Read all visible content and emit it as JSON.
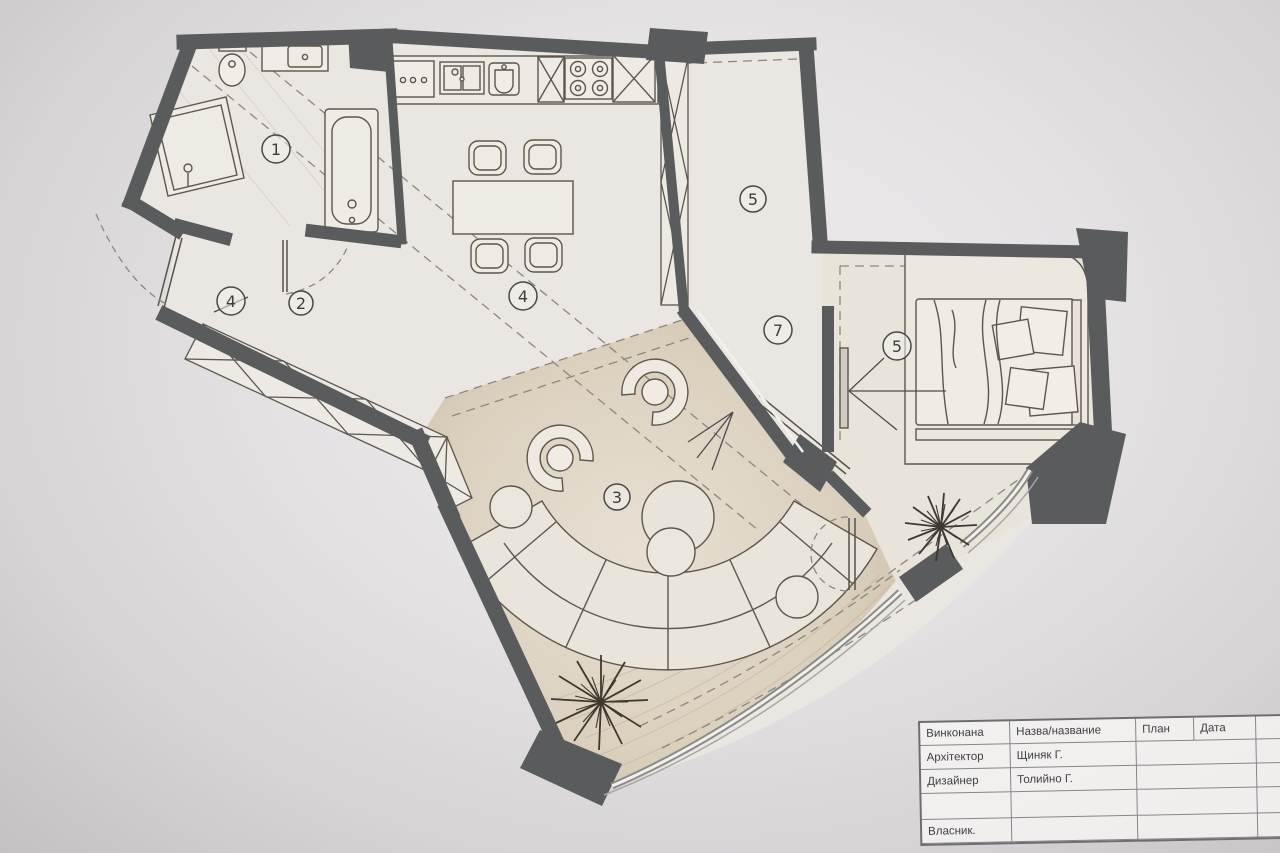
{
  "room_labels": {
    "bathroom": "1",
    "hallway": "2",
    "entry_marker": "4",
    "living": "3",
    "dining": "4",
    "corridor_wardrobe": "5",
    "bedroom_marker": "5",
    "door_marker": "7"
  },
  "title_block": {
    "header": {
      "c1": "Винконана",
      "c2": "Назва/название",
      "c3": "План",
      "c4": "Дата"
    },
    "rows": [
      [
        "Архітектор",
        "Щиняк Г."
      ],
      [
        "Дизайнер",
        "Толийно Г."
      ],
      [
        "",
        ""
      ],
      [
        "Власник.",
        ""
      ]
    ]
  },
  "colors": {
    "wall": "#595b5d",
    "paper": "#e0dedf",
    "living_floor": "#d5c9b7",
    "interior_floor": "#eae7e2",
    "line": "#5c564d"
  }
}
